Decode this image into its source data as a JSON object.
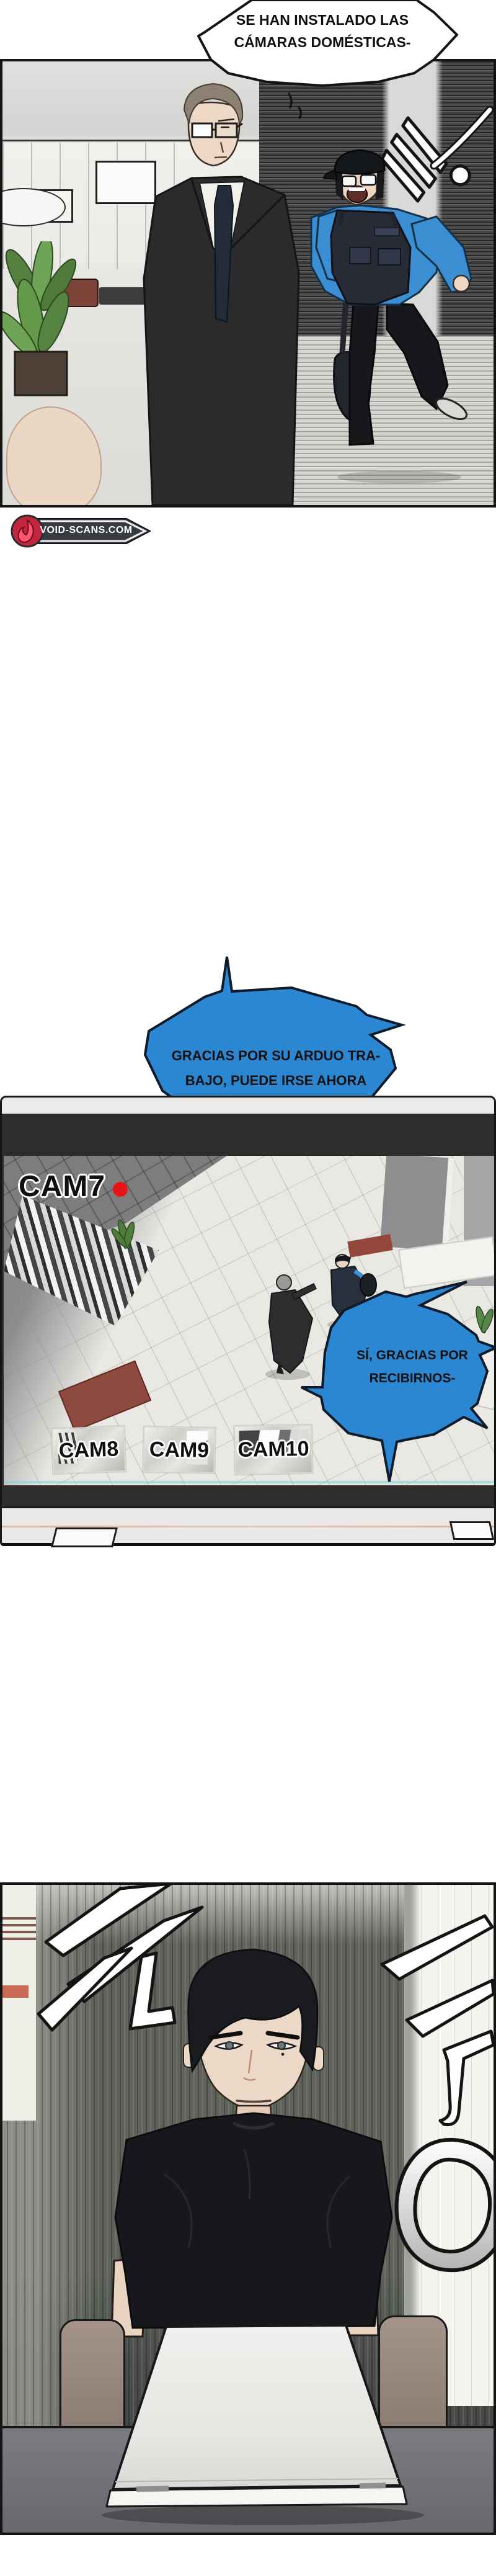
{
  "page_title": "manhwa-page",
  "panel1": {
    "bubble_installed": {
      "lines": [
        "SE HAN INSTALADO LAS",
        "CÁMARAS DOMÉSTICAS-"
      ]
    },
    "sfx_swish": "쌱"
  },
  "credit_badge": {
    "site": "VOID-SCANS.COM"
  },
  "bubble_thanks": {
    "lines": [
      "GRACIAS POR SU ARDUO TRA-",
      "BAJO, PUEDE IRSE AHORA"
    ]
  },
  "monitor": {
    "cam_label": "CAM7",
    "rec_dot": "recording",
    "thumbnails": [
      "CAM8",
      "CAM9",
      "CAM10"
    ],
    "bubble_reply": {
      "lines": [
        "SÍ, GRACIAS POR",
        "RECIBIRNOS-"
      ]
    }
  },
  "panel3": {
    "sfx_dramatic": "두둥"
  },
  "colors": {
    "bubble_blue": "#2b87d2",
    "bubble_outline": "#0d1b2a",
    "rec_red": "#e81418",
    "badge_dark": "#383c42",
    "badge_red": "#d92a50",
    "panel_border": "#141414"
  }
}
